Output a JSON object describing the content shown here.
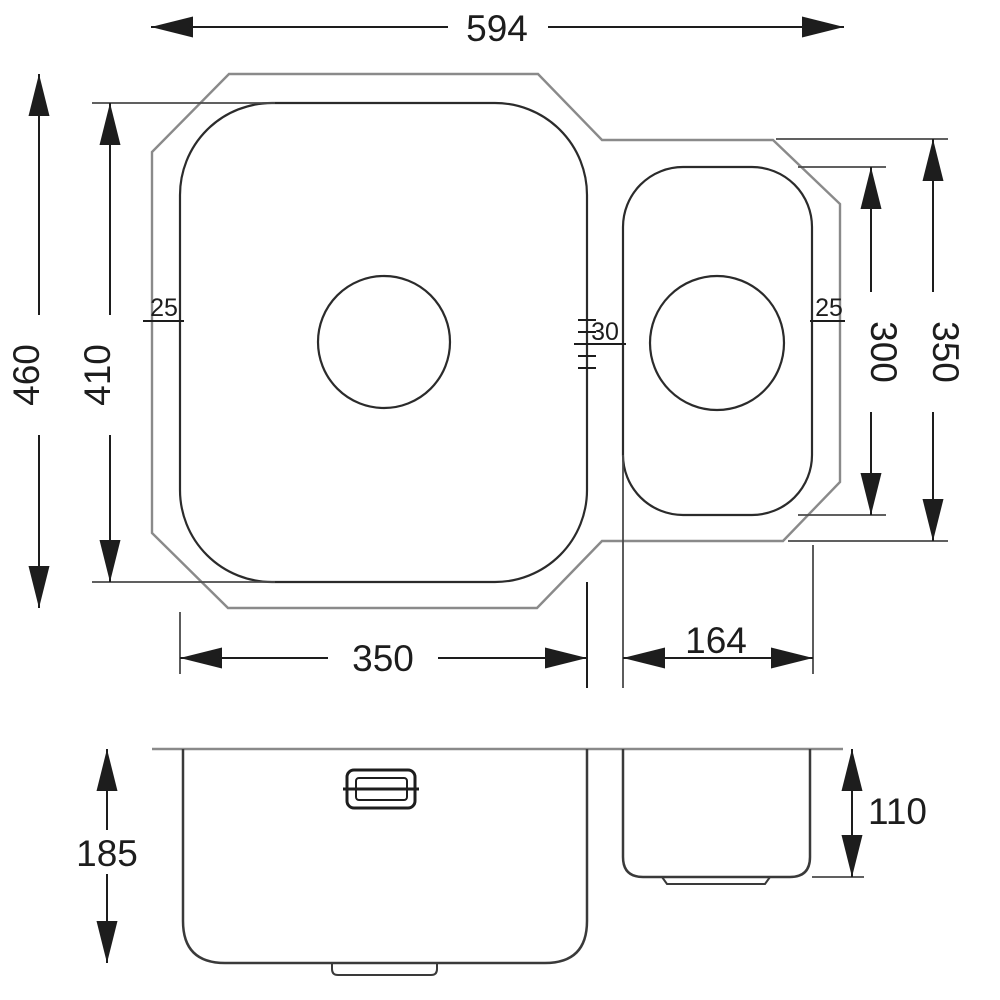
{
  "drawing": {
    "type": "sink-technical-drawing",
    "colors": {
      "dimension_line": "#1d1d1d",
      "rim_outline": "#8a8a8a",
      "bowl_outline": "#2b2b2b",
      "background": "#ffffff"
    },
    "plan_view": {
      "dims": {
        "overall_width": "594",
        "overall_depth": "460",
        "main_bowl_depth": "410",
        "main_bowl_width": "350",
        "small_bowl_width": "164",
        "small_bowl_depth": "300",
        "right_section_depth": "350",
        "rim_inset_left": "25",
        "rim_inset_right": "25",
        "bowl_divider_width": "30"
      }
    },
    "section_view": {
      "dims": {
        "main_bowl_height": "185",
        "small_bowl_height": "110"
      }
    }
  }
}
